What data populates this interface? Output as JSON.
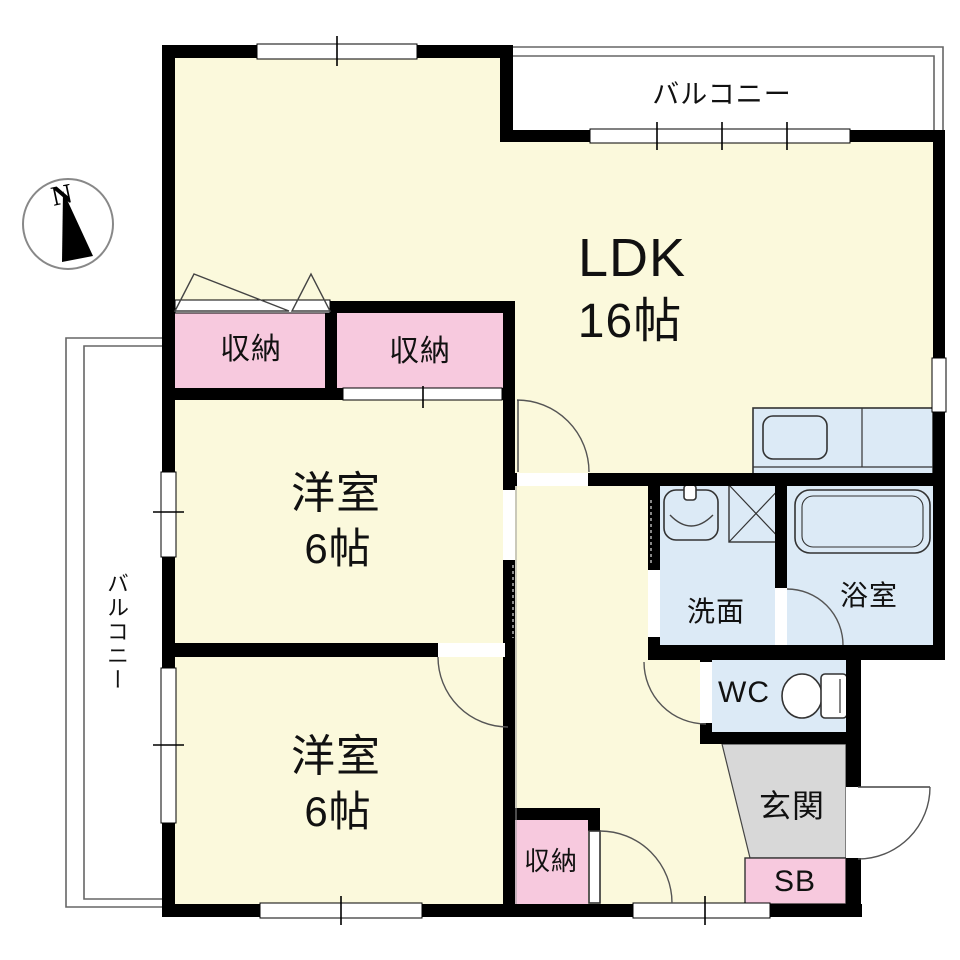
{
  "compass": {
    "north": "N"
  },
  "balcony_top": {
    "label": "バルコニー"
  },
  "balcony_left": {
    "label": "バルコニー"
  },
  "rooms": {
    "ldk": {
      "label": "LDK",
      "size": "16帖"
    },
    "bedroom1": {
      "label": "洋室",
      "size": "6帖"
    },
    "bedroom2": {
      "label": "洋室",
      "size": "6帖"
    },
    "washroom": {
      "label": "洗面"
    },
    "bathroom": {
      "label": "浴室"
    },
    "toilet": {
      "label": "WC"
    },
    "entrance": {
      "label": "玄関"
    },
    "shoe_box": {
      "label": "SB"
    },
    "closet_ldk": {
      "label": "収納"
    },
    "closet_bedroom1": {
      "label": "収納"
    },
    "closet_hall": {
      "label": "収納"
    }
  },
  "colors": {
    "room_floor": "#FBF9DC",
    "closet_pink": "#F7C9DE",
    "wet_area_blue": "#DCEAF6",
    "entrance_gray": "#D8D8D8",
    "wall": "#000000",
    "balcony_white": "#FFFFFF"
  }
}
